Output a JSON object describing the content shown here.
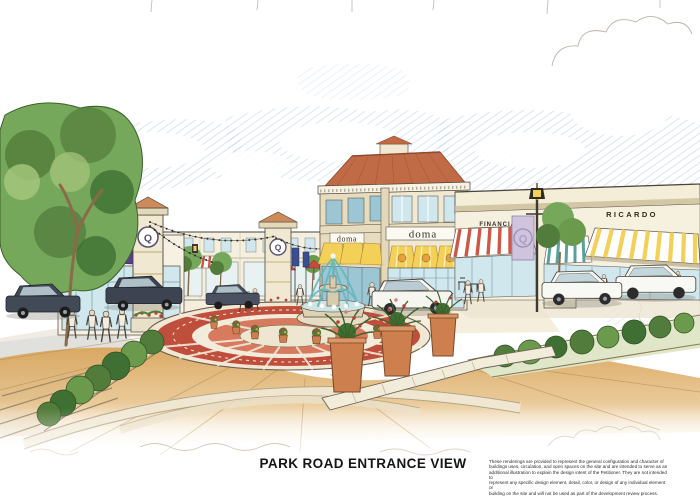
{
  "title": {
    "text": "PARK ROAD ENTRANCE VIEW"
  },
  "disclaimer": {
    "lines": [
      "These renderings are provided to represent the general configuration and character of",
      "buildings uses, circulation, and open spaces on the site and are intended to serve as an",
      "additional illustration to explain the design intent of the Petitioner.  They are not intended to",
      "represent any specific design element, detail, color, or design of any individual element or",
      "building on the site and will not be used as part of the development review process."
    ]
  },
  "signs": {
    "doma": "doma",
    "financial": "FINANCIAL",
    "ricardo": "RICARDO",
    "q_logo": "Q"
  },
  "colors": {
    "sky_hatch": "#b9d2e4",
    "wall_cream": "#f0e8d0",
    "roof_terracotta": "#c06b45",
    "awning_yellow": "#f3d158",
    "awning_purple": "#5b3c92",
    "awning_red": "#cd5847",
    "awning_teal": "#56a39e",
    "brick_red": "#bf4e3d",
    "foliage_green": "#76a85c",
    "road_tan": "#d9a55c",
    "fountain_teal": "#5fb7bd",
    "planter_terracotta": "#cd7f4e",
    "banner_lavender": "#cfc3de",
    "ink": "#4a453c"
  }
}
